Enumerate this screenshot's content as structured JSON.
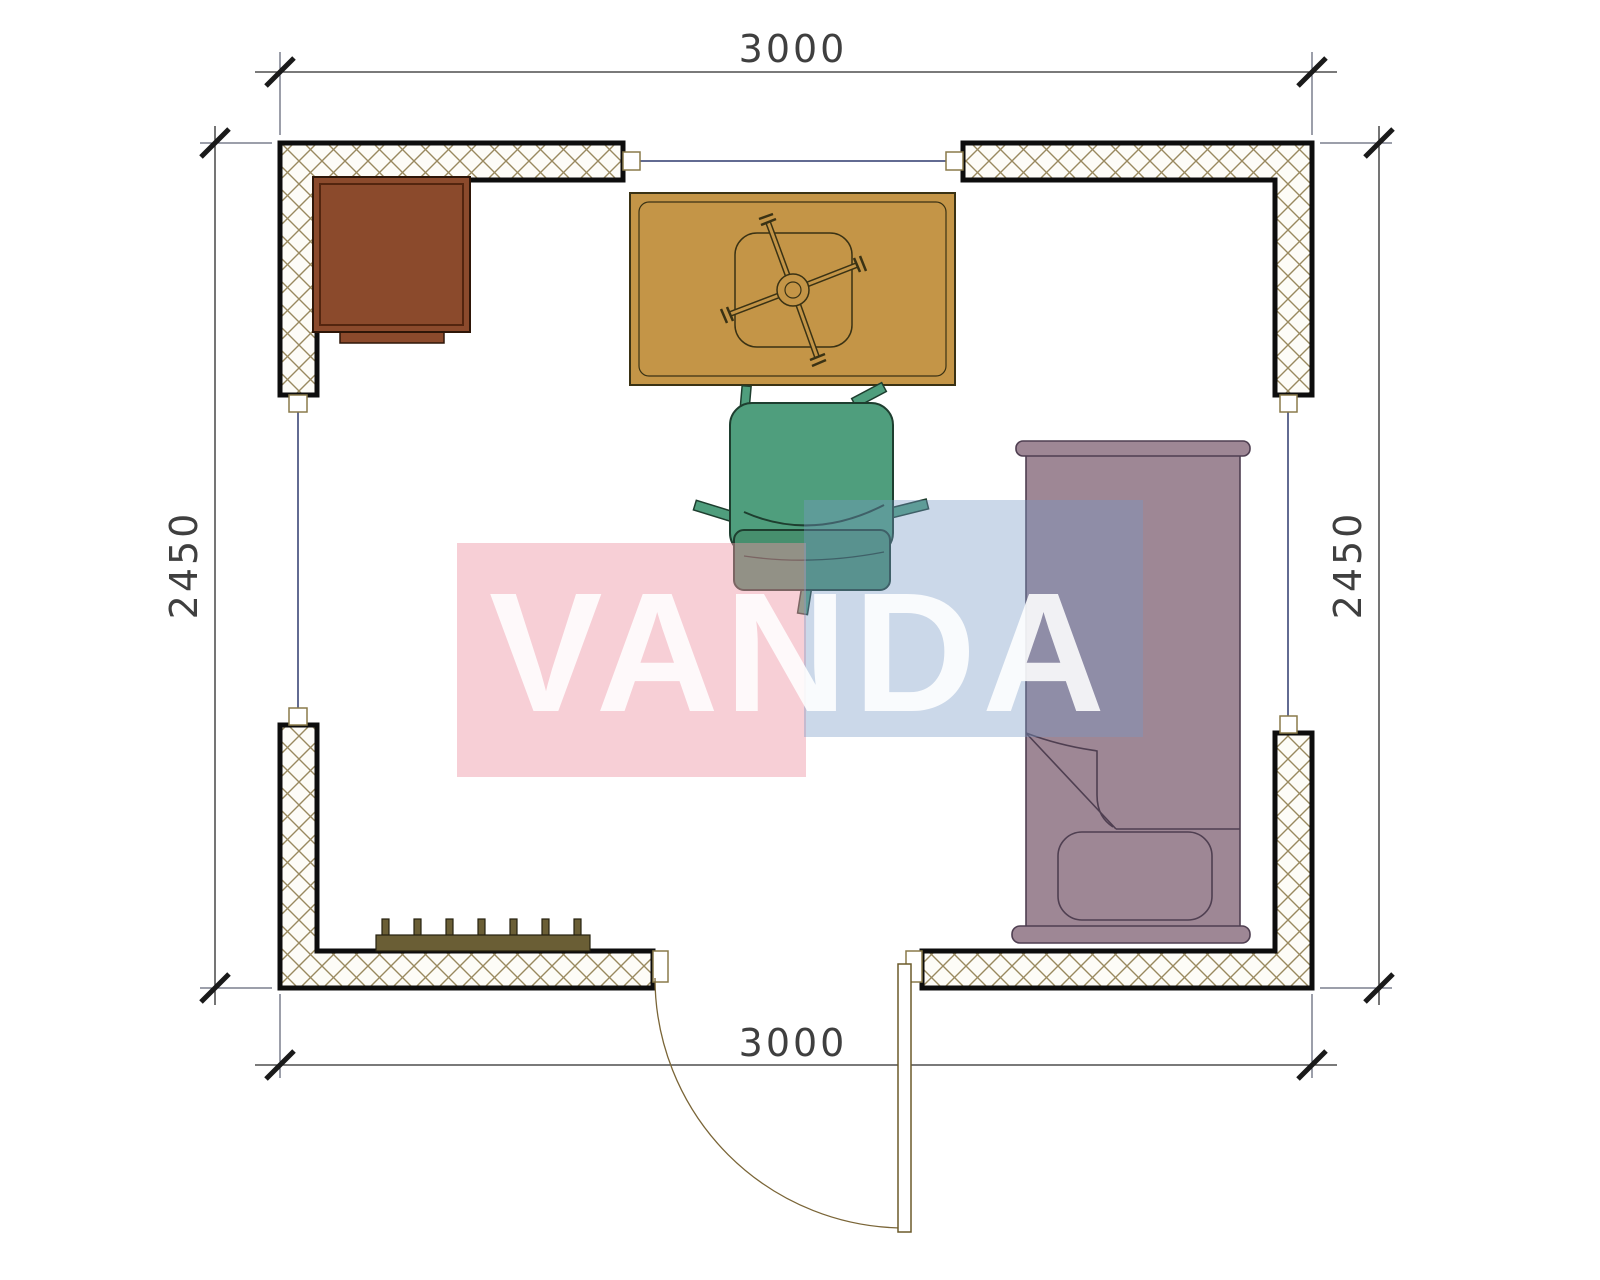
{
  "drawing": {
    "type": "floor-plan",
    "dimensions": {
      "top": "3000",
      "bottom": "3000",
      "left": "2450",
      "right": "2450"
    },
    "watermark": {
      "text": "VANDA",
      "pink_panel_color": "#f6ccd3",
      "blue_panel_color": "#ccd9e9",
      "text_color": "#ffffff"
    },
    "colors": {
      "wall_hatch": "#99895f",
      "wall_border": "#0d0d0d",
      "cabinet": "#8b4a2c",
      "table": "#c49547",
      "office_chair": "#4f9e7d",
      "bed": "#9e8795",
      "radiator": "#6a5e35",
      "door": "#7a6537",
      "window_line": "#2e3a6e",
      "dimension_text": "#3f3f3f"
    },
    "elements": [
      "wall-top-left",
      "wall-top-right",
      "wall-bottom-left",
      "wall-bottom-right",
      "window-top",
      "window-left",
      "window-right",
      "door",
      "cabinet",
      "table",
      "table-base-cross",
      "office-chair",
      "bed",
      "pillow",
      "radiator"
    ]
  }
}
